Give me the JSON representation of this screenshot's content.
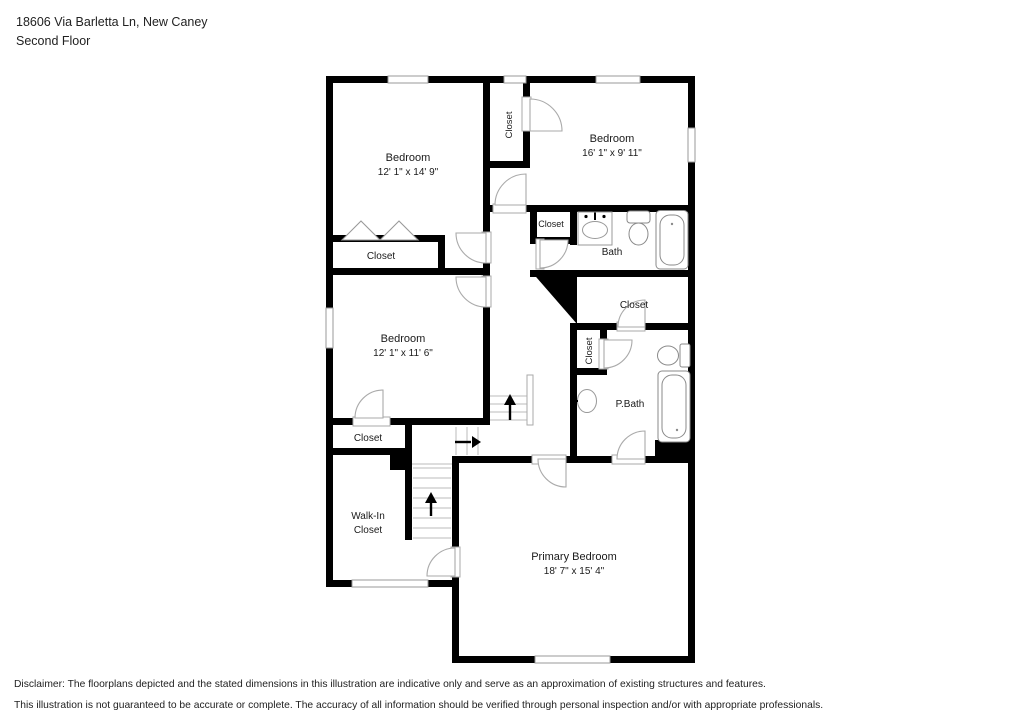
{
  "header": {
    "address": "18606 Via Barletta Ln, New Caney",
    "floor_label": "Second Floor"
  },
  "rooms": [
    {
      "id": "bedroom-top-left",
      "name": "Bedroom",
      "dims": "12' 1\" x 14' 9\""
    },
    {
      "id": "bedroom-top-right",
      "name": "Bedroom",
      "dims": "16' 1\" x 9' 11\""
    },
    {
      "id": "bedroom-middle",
      "name": "Bedroom",
      "dims": "12' 1\" x 11' 6\""
    },
    {
      "id": "primary-bedroom",
      "name": "Primary Bedroom",
      "dims": "18' 7\" x 15' 4\""
    },
    {
      "id": "bath",
      "name": "Bath"
    },
    {
      "id": "primary-bath",
      "name": "P.Bath"
    },
    {
      "id": "closet-hall-top",
      "name": "Closet"
    },
    {
      "id": "closet-left",
      "name": "Closet"
    },
    {
      "id": "closet-bath",
      "name": "Closet"
    },
    {
      "id": "closet-mid-right",
      "name": "Closet"
    },
    {
      "id": "closet-pbath",
      "name": "Closet"
    },
    {
      "id": "closet-below-middle",
      "name": "Closet"
    },
    {
      "id": "walk-in-closet",
      "name": "Walk-In Closet",
      "line1": "Walk-In",
      "line2": "Closet"
    }
  ],
  "stairs": {
    "direction_arrows": [
      "up",
      "right",
      "up"
    ]
  },
  "disclaimer": {
    "line1": "Disclaimer: The floorplans depicted and the stated dimensions in this illustration are indicative only and serve as an approximation of existing structures and features.",
    "line2": "This illustration is not guaranteed to be accurate or complete. The accuracy of all information should be verified through personal inspection and/or with appropriate professionals."
  },
  "colors": {
    "wall": "#000000",
    "background": "#ffffff",
    "door_stroke": "#aaaaaa",
    "fixture_stroke": "#8a8a8a",
    "stair_tread": "#bbbbbb",
    "text": "#1a1a1a"
  }
}
